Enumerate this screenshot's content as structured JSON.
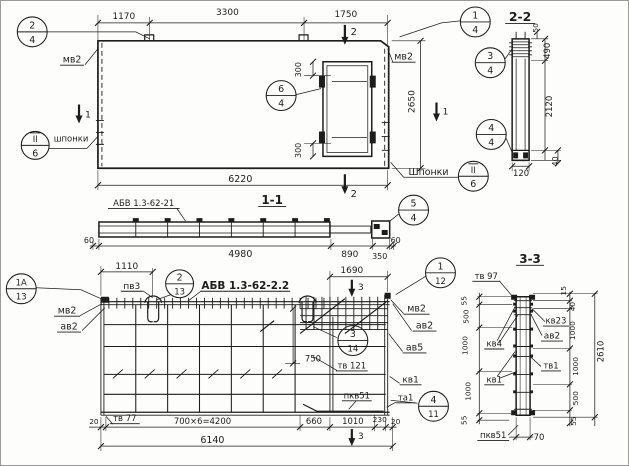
{
  "palette": {
    "paper": "#fdfdfb",
    "ink": "#1d1d1d"
  },
  "annotations": [
    {
      "name": "dim-1170",
      "text": "1170",
      "x": 123,
      "y": 18,
      "fs": 9
    },
    {
      "name": "dim-3300",
      "text": "3300",
      "x": 227,
      "y": 14,
      "fs": 9
    },
    {
      "name": "dim-1750",
      "text": "1750",
      "x": 346,
      "y": 16,
      "fs": 9
    },
    {
      "name": "label-mv2-top-left",
      "text": "мв2",
      "x": 71,
      "y": 62,
      "fs": 9.5,
      "ul": 24
    },
    {
      "name": "label-mv2-top-right",
      "text": "мв2",
      "x": 404,
      "y": 59,
      "fs": 9.5,
      "ul": 24
    },
    {
      "name": "dim-2650",
      "text": "2650",
      "x": 415,
      "y": 101,
      "fs": 9,
      "rot": -90
    },
    {
      "name": "label-shponki-left",
      "text": "шпонки",
      "x": 70,
      "y": 141,
      "fs": 8.5
    },
    {
      "name": "label-shponki-right",
      "text": "Шпонки",
      "x": 429,
      "y": 175,
      "fs": 9.5
    },
    {
      "name": "dim-6220",
      "text": "6220",
      "x": 240,
      "y": 182,
      "fs": 9.5
    },
    {
      "name": "dim-300-door-top",
      "text": "300",
      "x": 301,
      "y": 69,
      "fs": 8,
      "rot": -90
    },
    {
      "name": "dim-300-door-bottom",
      "text": "300",
      "x": 301,
      "y": 150,
      "fs": 8,
      "rot": -90
    },
    {
      "name": "cut-1-left-num",
      "text": "1",
      "x": 87,
      "y": 117,
      "fs": 9
    },
    {
      "name": "cut-1-right-num",
      "text": "1",
      "x": 446,
      "y": 114,
      "fs": 9
    },
    {
      "name": "cut-2-top-num",
      "text": "2",
      "x": 354,
      "y": 34,
      "fs": 10
    },
    {
      "name": "cut-2-bottom-num",
      "text": "2",
      "x": 354,
      "y": 197,
      "fs": 10
    },
    {
      "name": "title-section-1-1",
      "text": "1-1",
      "x": 272,
      "y": 204,
      "fs": 12,
      "ul": 28,
      "bold": true
    },
    {
      "name": "label-mark-abv-21",
      "text": "АБВ 1.3-62-21",
      "x": 143,
      "y": 206,
      "fs": 8.5,
      "ul": 72
    },
    {
      "name": "dim-60-left-11",
      "text": "60",
      "x": 88,
      "y": 243,
      "fs": 8
    },
    {
      "name": "dim-4980",
      "text": "4980",
      "x": 240,
      "y": 257,
      "fs": 9.5
    },
    {
      "name": "dim-890",
      "text": "890",
      "x": 350,
      "y": 257,
      "fs": 9
    },
    {
      "name": "dim-350",
      "text": "350",
      "x": 380,
      "y": 259,
      "fs": 8
    },
    {
      "name": "dim-60-right-11",
      "text": "60",
      "x": 396,
      "y": 243,
      "fs": 8
    },
    {
      "name": "title-section-2-2",
      "text": "2-2",
      "x": 521,
      "y": 20,
      "fs": 12.5,
      "ul": 30,
      "bold": true
    },
    {
      "name": "dim-50",
      "text": "50",
      "x": 539,
      "y": 27,
      "fs": 7.5,
      "rot": -90
    },
    {
      "name": "dim-490",
      "text": "490",
      "x": 551,
      "y": 50,
      "fs": 8.5,
      "rot": -90
    },
    {
      "name": "dim-2120",
      "text": "2120",
      "x": 553,
      "y": 106,
      "fs": 8.5,
      "rot": -90
    },
    {
      "name": "dim-40-22",
      "text": "40",
      "x": 559,
      "y": 161,
      "fs": 8,
      "rot": -90
    },
    {
      "name": "dim-120",
      "text": "120",
      "x": 522,
      "y": 176,
      "fs": 8.5
    },
    {
      "name": "dim-1110",
      "text": "1110",
      "x": 126,
      "y": 269,
      "fs": 9
    },
    {
      "name": "label-pv3",
      "text": "пв3",
      "x": 131,
      "y": 289,
      "fs": 9,
      "ul": 22
    },
    {
      "name": "label-mark-abv-22",
      "text": "АБВ 1.3-62-2.2",
      "x": 245,
      "y": 289,
      "fs": 10.5,
      "ul": 90,
      "bold": true
    },
    {
      "name": "dim-1690",
      "text": "1690",
      "x": 352,
      "y": 273,
      "fs": 9
    },
    {
      "name": "cut-3-top-num",
      "text": "3",
      "x": 361,
      "y": 290,
      "fs": 9
    },
    {
      "name": "cut-3-bottom-num",
      "text": "3",
      "x": 361,
      "y": 440,
      "fs": 9
    },
    {
      "name": "label-mv2-bot-left",
      "text": "мв2",
      "x": 66,
      "y": 314,
      "fs": 9.5,
      "ul": 26
    },
    {
      "name": "label-av2-bot-left",
      "text": "ав2",
      "x": 68,
      "y": 330,
      "fs": 9.5,
      "ul": 24
    },
    {
      "name": "label-mv2-bot-right",
      "text": "мв2",
      "x": 417,
      "y": 312,
      "fs": 9.5,
      "ul": 26
    },
    {
      "name": "label-av2-bot-right",
      "text": "ав2",
      "x": 425,
      "y": 329,
      "fs": 9.5,
      "ul": 24
    },
    {
      "name": "label-av5",
      "text": "ав5",
      "x": 415,
      "y": 351,
      "fs": 9.5,
      "ul": 24
    },
    {
      "name": "label-kv1-bottom",
      "text": "кв1",
      "x": 411,
      "y": 383,
      "fs": 9,
      "ul": 22
    },
    {
      "name": "label-ta1",
      "text": "та1",
      "x": 406,
      "y": 401,
      "fs": 8.5,
      "ul": 20
    },
    {
      "name": "label-pkv51-bottom",
      "text": "пкв51",
      "x": 357,
      "y": 399,
      "fs": 8.5,
      "ul": 30
    },
    {
      "name": "dim-750",
      "text": "750",
      "x": 313,
      "y": 362,
      "fs": 8.5
    },
    {
      "name": "label-tv121",
      "text": "тв 121",
      "x": 352,
      "y": 369,
      "fs": 8.5,
      "ul": 32
    },
    {
      "name": "label-tv77",
      "text": "тв 77",
      "x": 124,
      "y": 422,
      "fs": 8.5,
      "ul": 30
    },
    {
      "name": "dim-20-left",
      "text": "20",
      "x": 93,
      "y": 425,
      "fs": 7.5
    },
    {
      "name": "dim-700x6",
      "text": "700×6=4200",
      "x": 202,
      "y": 425,
      "fs": 8.5
    },
    {
      "name": "dim-660",
      "text": "660",
      "x": 314,
      "y": 425,
      "fs": 8.5
    },
    {
      "name": "dim-1010",
      "text": "1010",
      "x": 353,
      "y": 425,
      "fs": 8.5
    },
    {
      "name": "dim-230",
      "text": "230",
      "x": 380,
      "y": 423,
      "fs": 7.5
    },
    {
      "name": "dim-20-right",
      "text": "20",
      "x": 396,
      "y": 425,
      "fs": 7.5
    },
    {
      "name": "dim-6140",
      "text": "6140",
      "x": 212,
      "y": 444,
      "fs": 9.5
    },
    {
      "name": "title-section-3-3",
      "text": "3-3",
      "x": 531,
      "y": 263,
      "fs": 12,
      "ul": 28,
      "bold": true
    },
    {
      "name": "label-tv97",
      "text": "тв 97",
      "x": 487,
      "y": 279,
      "fs": 8.5,
      "ul": 28
    },
    {
      "name": "dim-55-left-top",
      "text": "55",
      "x": 467,
      "y": 301,
      "fs": 7.5,
      "rot": -90
    },
    {
      "name": "dim-500-left",
      "text": "500",
      "x": 469,
      "y": 317,
      "fs": 7.5,
      "rot": -90
    },
    {
      "name": "dim-1000-left-1",
      "text": "1000",
      "x": 468,
      "y": 346,
      "fs": 7.5,
      "rot": -90
    },
    {
      "name": "dim-1000-left-2",
      "text": "1000",
      "x": 471,
      "y": 392,
      "fs": 7.5,
      "rot": -90
    },
    {
      "name": "dim-55-left-bottom",
      "text": "55",
      "x": 467,
      "y": 421,
      "fs": 7.5,
      "rot": -90
    },
    {
      "name": "dim-15-right",
      "text": "15",
      "x": 567,
      "y": 291,
      "fs": 7.5,
      "rot": -90
    },
    {
      "name": "dim-40-right",
      "text": "40",
      "x": 576,
      "y": 307,
      "fs": 7.5,
      "rot": -90
    },
    {
      "name": "dim-1000-right-1",
      "text": "1000",
      "x": 576,
      "y": 331,
      "fs": 7.5,
      "rot": -90
    },
    {
      "name": "dim-1000-right-2",
      "text": "1000",
      "x": 579,
      "y": 367,
      "fs": 7.5,
      "rot": -90
    },
    {
      "name": "dim-500-right",
      "text": "500",
      "x": 579,
      "y": 399,
      "fs": 7.5,
      "rot": -90
    },
    {
      "name": "dim-55-right",
      "text": "55",
      "x": 577,
      "y": 422,
      "fs": 7.5,
      "rot": -90
    },
    {
      "name": "dim-2610",
      "text": "2610",
      "x": 605,
      "y": 352,
      "fs": 8.5,
      "rot": -90
    },
    {
      "name": "label-kv23",
      "text": "кв23",
      "x": 557,
      "y": 324,
      "fs": 8.5,
      "ul": 26
    },
    {
      "name": "label-av2-33",
      "text": "ав2",
      "x": 553,
      "y": 339,
      "fs": 9,
      "ul": 22
    },
    {
      "name": "label-kv4",
      "text": "кв4",
      "x": 495,
      "y": 347,
      "fs": 8.5,
      "ul": 20
    },
    {
      "name": "label-tv1",
      "text": "тв1",
      "x": 552,
      "y": 369,
      "fs": 8.5,
      "ul": 20
    },
    {
      "name": "label-kv1-33",
      "text": "кв1",
      "x": 495,
      "y": 383,
      "fs": 8.5,
      "ul": 20
    },
    {
      "name": "label-pkv51-33",
      "text": "пкв51",
      "x": 494,
      "y": 439,
      "fs": 8.5,
      "ul": 32
    },
    {
      "name": "dim-70",
      "text": "70",
      "x": 540,
      "y": 441,
      "fs": 8.5
    }
  ],
  "callouts": [
    {
      "name": "callout-2-4",
      "top": "2",
      "bottom": "4",
      "cx": 31,
      "cy": 31,
      "r": 15
    },
    {
      "name": "callout-1-4",
      "top": "1",
      "bottom": "4",
      "cx": 476,
      "cy": 21,
      "r": 15
    },
    {
      "name": "callout-6-4",
      "top": "6",
      "bottom": "4",
      "cx": 281,
      "cy": 95,
      "r": 15
    },
    {
      "name": "callout-II-6-left",
      "top": "II",
      "bottom": "6",
      "cx": 34,
      "cy": 145,
      "r": 14,
      "overline": true
    },
    {
      "name": "callout-3-4",
      "top": "3",
      "bottom": "4",
      "cx": 491,
      "cy": 62,
      "r": 15
    },
    {
      "name": "callout-4-4",
      "top": "4",
      "bottom": "4",
      "cx": 492,
      "cy": 134,
      "r": 15
    },
    {
      "name": "callout-II-6-right",
      "top": "II",
      "bottom": "6",
      "cx": 474,
      "cy": 176,
      "r": 15,
      "overline": true
    },
    {
      "name": "callout-5-4",
      "top": "5",
      "bottom": "4",
      "cx": 414,
      "cy": 210,
      "r": 15
    },
    {
      "name": "callout-2-13",
      "top": "2",
      "bottom": "13",
      "cx": 179,
      "cy": 284,
      "r": 14
    },
    {
      "name": "callout-1A-13",
      "top": "1А",
      "bottom": "13",
      "cx": 20,
      "cy": 289,
      "r": 15
    },
    {
      "name": "callout-1-12",
      "top": "1",
      "bottom": "12",
      "cx": 441,
      "cy": 273,
      "r": 15
    },
    {
      "name": "callout-3-14",
      "top": "3",
      "bottom": "14",
      "cx": 353,
      "cy": 341,
      "r": 15
    },
    {
      "name": "callout-4-11",
      "top": "4",
      "bottom": "11",
      "cx": 434,
      "cy": 407,
      "r": 15
    }
  ]
}
